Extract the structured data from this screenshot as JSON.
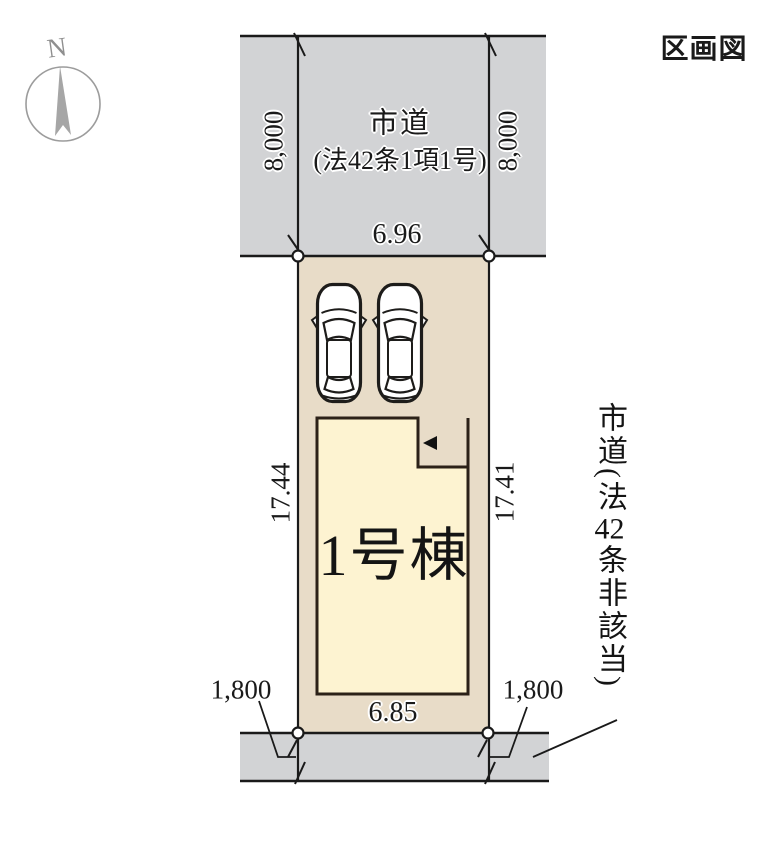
{
  "title": "区画図",
  "compass": {
    "label": "N"
  },
  "top_road": {
    "name_line1": "市道",
    "name_line2": "(法42条1項1号)",
    "depth_left": "8,000",
    "depth_right": "8,000",
    "frontage_top": "6.96"
  },
  "plot": {
    "side_left": "17.44",
    "side_right": "17.41",
    "frontage_bottom": "6.85",
    "offset_left": "1,800",
    "offset_right": "1,800"
  },
  "building": {
    "label": "1号棟"
  },
  "right_road": {
    "label": "市道(法42条非該当)",
    "part_before": "市道(法",
    "part_number": "42",
    "part_after": "条非該当)"
  },
  "colors": {
    "road_fill": "#d2d3d5",
    "plot_fill": "#e8dcc8",
    "building_fill": "#fdf3d1",
    "line": "#1a1a1a",
    "compass_gray": "#9c9c9c"
  }
}
